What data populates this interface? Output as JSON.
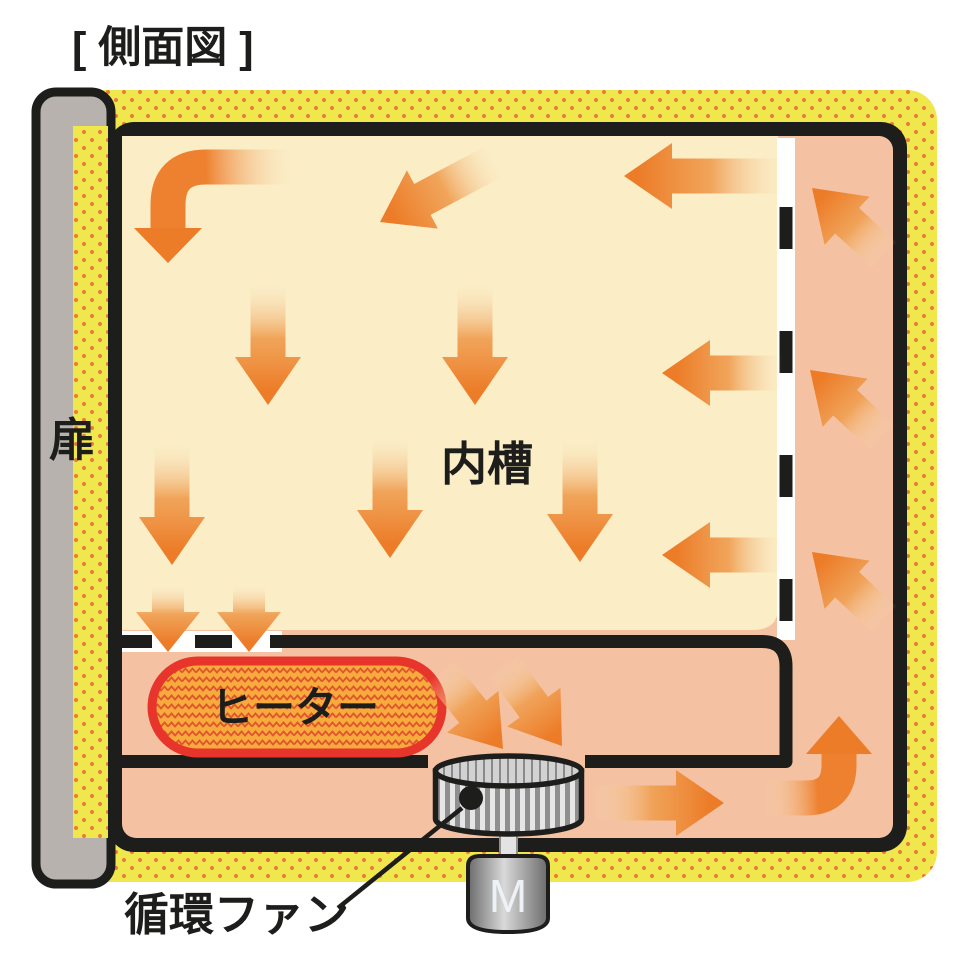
{
  "title": "[ 側面図 ]",
  "labels": {
    "door": "扉",
    "inner_chamber": "内槽",
    "heater": "ヒーター",
    "circulation_fan": "循環ファン",
    "motor": "M"
  },
  "airflow": {
    "description": "Heated air blows down through the inner chamber, passes heater gaps, is pushed by the circulation fan along the bottom duct, rises in the right duct and re-enters the chamber",
    "inner_chamber_arrows": "downward and leftward",
    "right_duct_arrows": "upward diagonal",
    "bottom_duct_arrows": "rightward toward corner"
  },
  "colors": {
    "insulation_yellow": "#f0e74d",
    "insulation_dot_orange": "#e87a3f",
    "chamber_cream": "#fbedc6",
    "duct_salmon": "#f4c2a2",
    "arrow_orange": "#ec7c28",
    "heater_fill": "#f6ab3c",
    "heater_zigzag": "#e0542e",
    "heater_border": "#e8352b",
    "door_gray": "#b7b2ae",
    "outline_black": "#1d1d1b",
    "fan_gray": "#c9c9c9",
    "motor_gray": "#9a9a9a"
  }
}
